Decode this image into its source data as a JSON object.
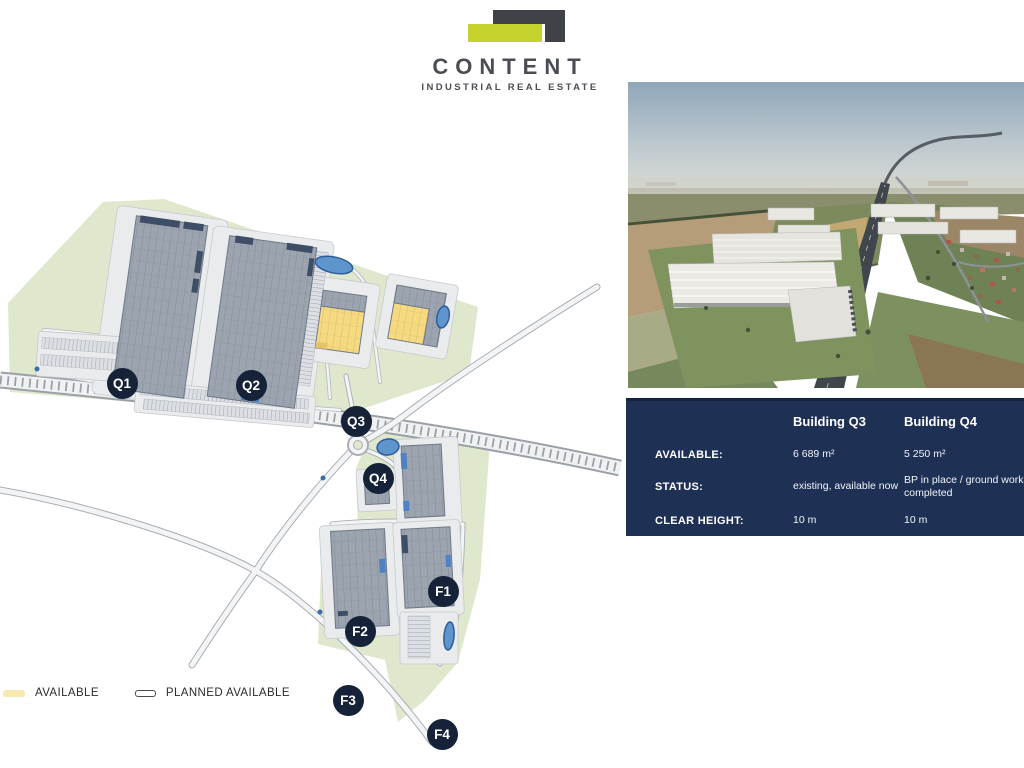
{
  "logo": {
    "title": "CONTENT",
    "subtitle": "INDUSTRIAL REAL ESTATE"
  },
  "map": {
    "labels": [
      {
        "id": "Q1",
        "x": 122,
        "y": 233
      },
      {
        "id": "Q2",
        "x": 251,
        "y": 235
      },
      {
        "id": "Q3",
        "x": 356,
        "y": 271
      },
      {
        "id": "Q4",
        "x": 378,
        "y": 328
      },
      {
        "id": "F1",
        "x": 443,
        "y": 441
      },
      {
        "id": "F2",
        "x": 360,
        "y": 481
      },
      {
        "id": "F3",
        "x": 348,
        "y": 550
      },
      {
        "id": "F4",
        "x": 442,
        "y": 584
      }
    ],
    "legend": [
      {
        "label": "AVAILABLE",
        "type": "available",
        "color": "#f7e8b0"
      },
      {
        "label": "PLANNED AVAILABLE",
        "type": "planned",
        "color": "#ffffff"
      }
    ],
    "colors": {
      "available_building": "#f5da82",
      "planned_building": "#9aa3ae",
      "green_area": "#dfe8cd",
      "pond": "#5e95cd",
      "label_circle": "#152238"
    }
  },
  "table": {
    "columns": [
      "Building Q3",
      "Building Q4"
    ],
    "rows": [
      {
        "label": "AVAILABLE:",
        "q3": "6 689 m²",
        "q4": "5 250 m²"
      },
      {
        "label": "STATUS:",
        "q3": "existing, available now",
        "q4": "BP in place / ground works completed"
      },
      {
        "label": "CLEAR HEIGHT:",
        "q3": "10 m",
        "q4": "10 m"
      }
    ],
    "background": "#1e3054"
  },
  "brand_colors": {
    "navy": "#1e3054",
    "lime": "#c6d22e",
    "dark_gray": "#3f4347"
  }
}
